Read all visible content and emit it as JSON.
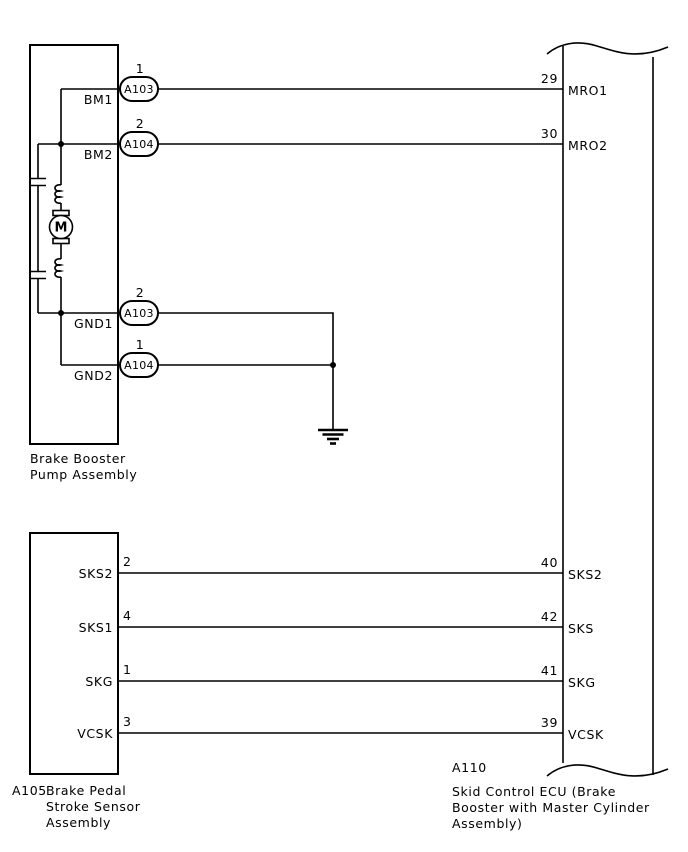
{
  "components": {
    "pump_assembly": {
      "caption_lines": [
        "Brake Booster",
        "Pump Assembly"
      ],
      "motor_label": "M",
      "terminals": [
        {
          "terminal": "BM1",
          "connector": "A103",
          "pin": "1"
        },
        {
          "terminal": "BM2",
          "connector": "A104",
          "pin": "2"
        },
        {
          "terminal": "GND1",
          "connector": "A103",
          "pin": "2"
        },
        {
          "terminal": "GND2",
          "connector": "A104",
          "pin": "1"
        }
      ]
    },
    "stroke_sensor": {
      "code": "A105",
      "caption_lines": [
        "Brake Pedal",
        "Stroke Sensor",
        "Assembly"
      ],
      "terminals": [
        {
          "terminal": "SKS2",
          "pin": "2"
        },
        {
          "terminal": "SKS1",
          "pin": "4"
        },
        {
          "terminal": "SKG",
          "pin": "1"
        },
        {
          "terminal": "VCSK",
          "pin": "3"
        }
      ]
    },
    "skid_control_ecu": {
      "code": "A110",
      "caption_lines": [
        "Skid Control ECU (Brake",
        "Booster with Master Cylinder",
        "Assembly)"
      ],
      "terminals": [
        {
          "terminal": "MRO1",
          "pin": "29"
        },
        {
          "terminal": "MRO2",
          "pin": "30"
        },
        {
          "terminal": "SKS2",
          "pin": "40"
        },
        {
          "terminal": "SKS",
          "pin": "42"
        },
        {
          "terminal": "SKG",
          "pin": "41"
        },
        {
          "terminal": "VCSK",
          "pin": "39"
        }
      ]
    }
  },
  "colors": {
    "line": "#000000",
    "background": "#ffffff"
  }
}
